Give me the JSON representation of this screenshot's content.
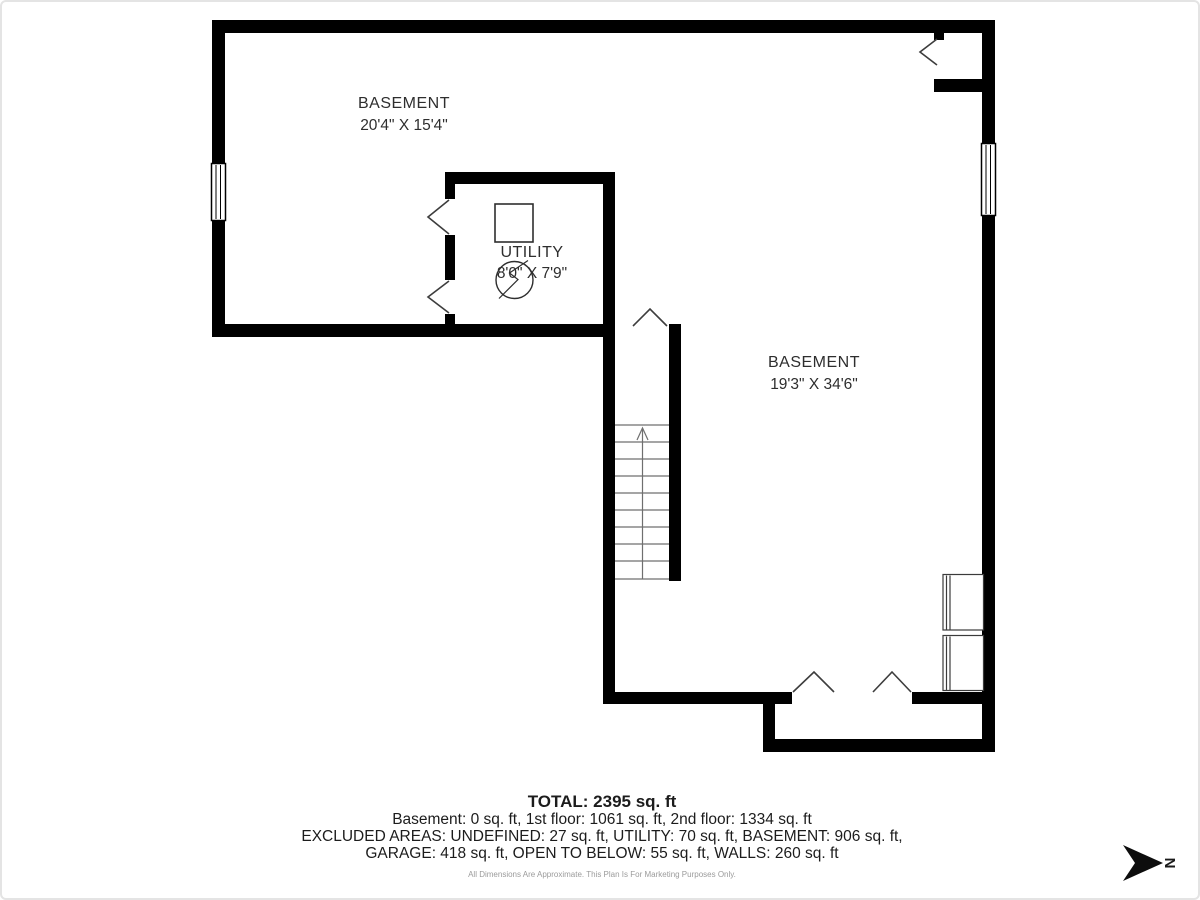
{
  "rooms": {
    "basement_upper": {
      "name": "BASEMENT",
      "dimensions": "20'4\" X 15'4\""
    },
    "utility": {
      "name": "UTILITY",
      "dimensions": "8'0\" X 7'9\""
    },
    "basement_lower": {
      "name": "BASEMENT",
      "dimensions": "19'3\" X 34'6\""
    }
  },
  "summary": {
    "total": "TOTAL: 2395 sq. ft",
    "floors": "Basement: 0 sq. ft, 1st floor: 1061 sq. ft, 2nd floor: 1334 sq. ft",
    "excluded_line1": "EXCLUDED AREAS: UNDEFINED: 27 sq. ft, UTILITY: 70 sq. ft, BASEMENT: 906 sq. ft,",
    "excluded_line2": "GARAGE: 418 sq. ft, OPEN TO BELOW: 55 sq. ft, WALLS: 260 sq. ft",
    "disclaimer": "All Dimensions Are Approximate. This Plan Is For Marketing Purposes Only."
  },
  "compass": {
    "label": "N"
  },
  "colors": {
    "wall": "#000000",
    "door_line": "#3d3d3d",
    "stair_line": "#6f6f6f",
    "symbol_line": "#2e2e2e",
    "text": "#2e2e2e",
    "muted": "#9b9b9b"
  }
}
